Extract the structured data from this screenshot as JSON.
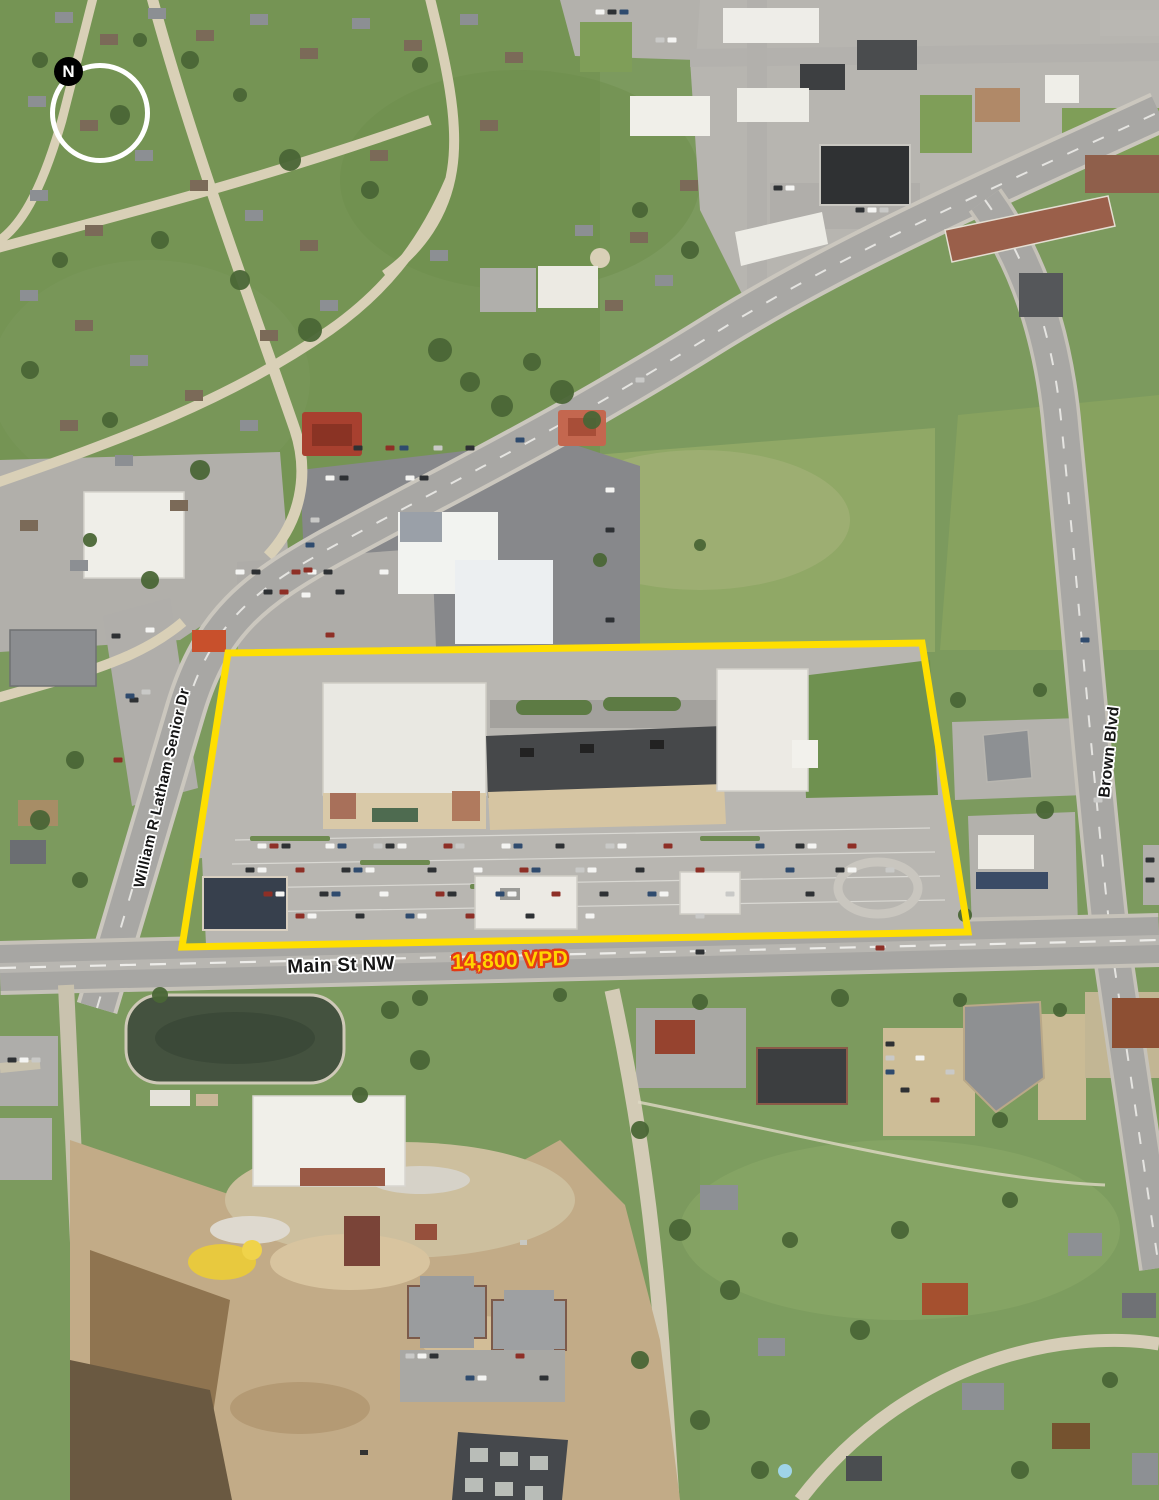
{
  "map": {
    "compass": {
      "label": "N"
    },
    "streets": {
      "william_latham": "William R Latham Senior Dr",
      "main_st": "Main St NW",
      "brown_blvd": "Brown Blvd"
    },
    "traffic": {
      "count": "14,800 VPD"
    },
    "parcel": {
      "outline_color": "#ffdf00"
    },
    "colors": {
      "traffic_text": "#ffd400",
      "traffic_outline": "#e33b16",
      "street_label_fill": "#161616",
      "street_label_halo": "#ffffff",
      "compass_ring": "#ffffff",
      "compass_badge": "#000000"
    }
  }
}
